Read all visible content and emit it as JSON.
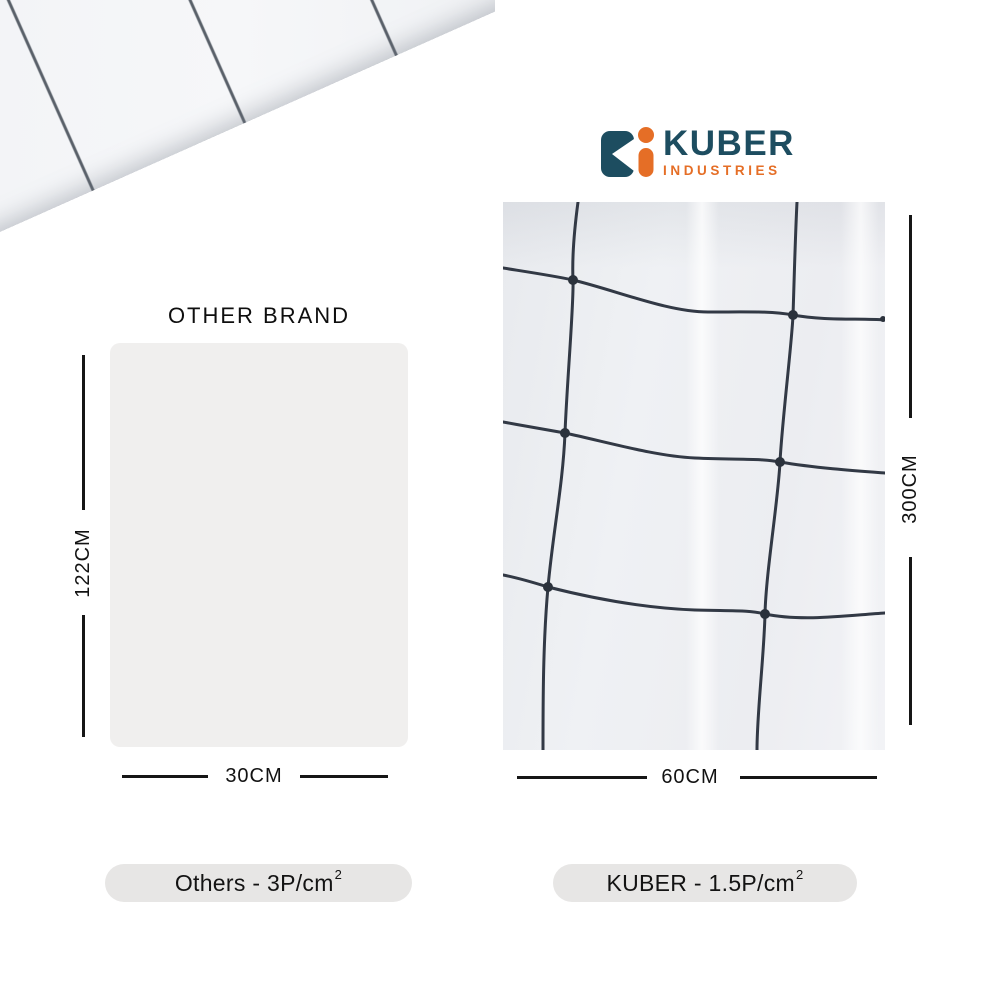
{
  "logo": {
    "brand": "KUBER",
    "industries": "INDUSTRIES"
  },
  "left": {
    "title": "OTHER BRAND",
    "height": "122CM",
    "width": "30CM",
    "pill_text": "Others - 3P/cm",
    "pill_sup": "2"
  },
  "right": {
    "height": "300CM",
    "width": "60CM",
    "pill_text": "KUBER - 1.5P/cm",
    "pill_sup": "2"
  },
  "colors": {
    "logo_teal": "#1d4d60",
    "logo_orange": "#e56e26",
    "sheet_gray": "#f0efee",
    "pill_gray": "#e7e6e5",
    "dimension_black": "#161616",
    "grid_line": "#39404b",
    "photo_base": "#edeff2"
  }
}
